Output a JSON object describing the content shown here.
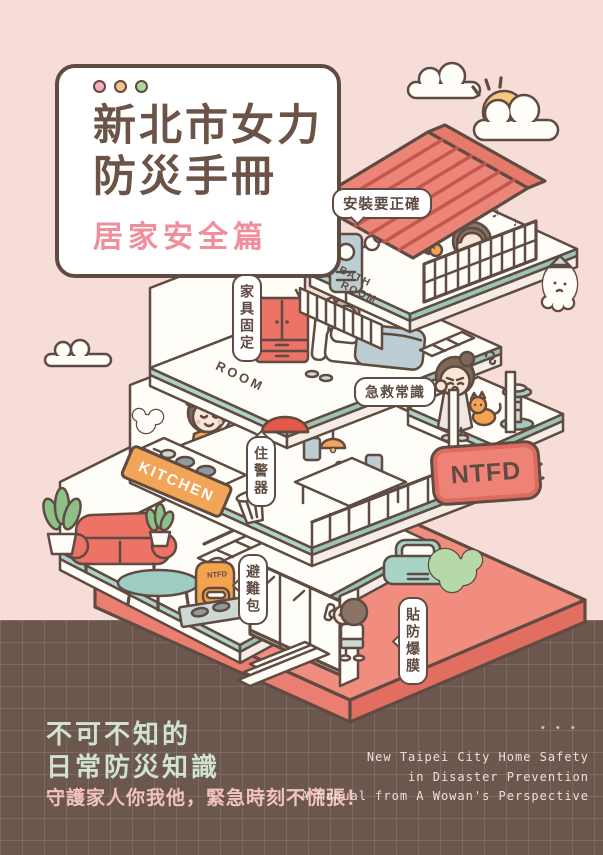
{
  "poster": {
    "width": 603,
    "height": 855,
    "colors": {
      "background": "#f6ddd8",
      "footer_background": "#6b574e",
      "outline_brown": "#5f4b41",
      "title_brown": "#6b5347",
      "subtitle_pink": "#f08e9c",
      "mint": "#aed2c6",
      "roof_red": "#ec8578",
      "roof_stripe": "#c4574d",
      "platform_salmon": "#f18d7e",
      "kitchen_sign_orange": "#f2a459",
      "ntfd_sign_red": "#ee8276",
      "footer_heading_green": "#cfe3cf",
      "footer_tagline_pink": "#f3c1c0",
      "footer_english_cream": "#eee0d8"
    }
  },
  "title_card": {
    "dots": [
      {
        "name": "pink-dot",
        "color": "#f6aeb9"
      },
      {
        "name": "orange-dot",
        "color": "#f6c390"
      },
      {
        "name": "green-dot",
        "color": "#aed69f"
      }
    ],
    "title_line1": "新北市女力",
    "title_line2": "防災手冊",
    "subtitle": "居家安全篇"
  },
  "house": {
    "callouts": {
      "install": "安裝要正確",
      "furniture": "家具固定",
      "first_aid": "急救常識",
      "alarm": "住警器",
      "go_bag": "避難包",
      "film": "貼防爆膜"
    },
    "signs": {
      "bath_line1": "BATH",
      "bath_line2": "ROOM",
      "room": "ROOM",
      "kitchen": "KITCHEN",
      "ntfd": "NTFD",
      "backpack": "NTFD"
    },
    "doodles": {
      "music_note": "♪"
    }
  },
  "footer": {
    "heading_line1": "不可不知的",
    "heading_line2": "日常防災知識",
    "tagline": "守護家人你我他，緊急時刻不慌張！",
    "dots": "• • •",
    "english_line1": "New Taipei City Home Safety",
    "english_line2": "in Disaster Prevention",
    "english_line3": "A Manual from A Wowan's Perspective"
  }
}
